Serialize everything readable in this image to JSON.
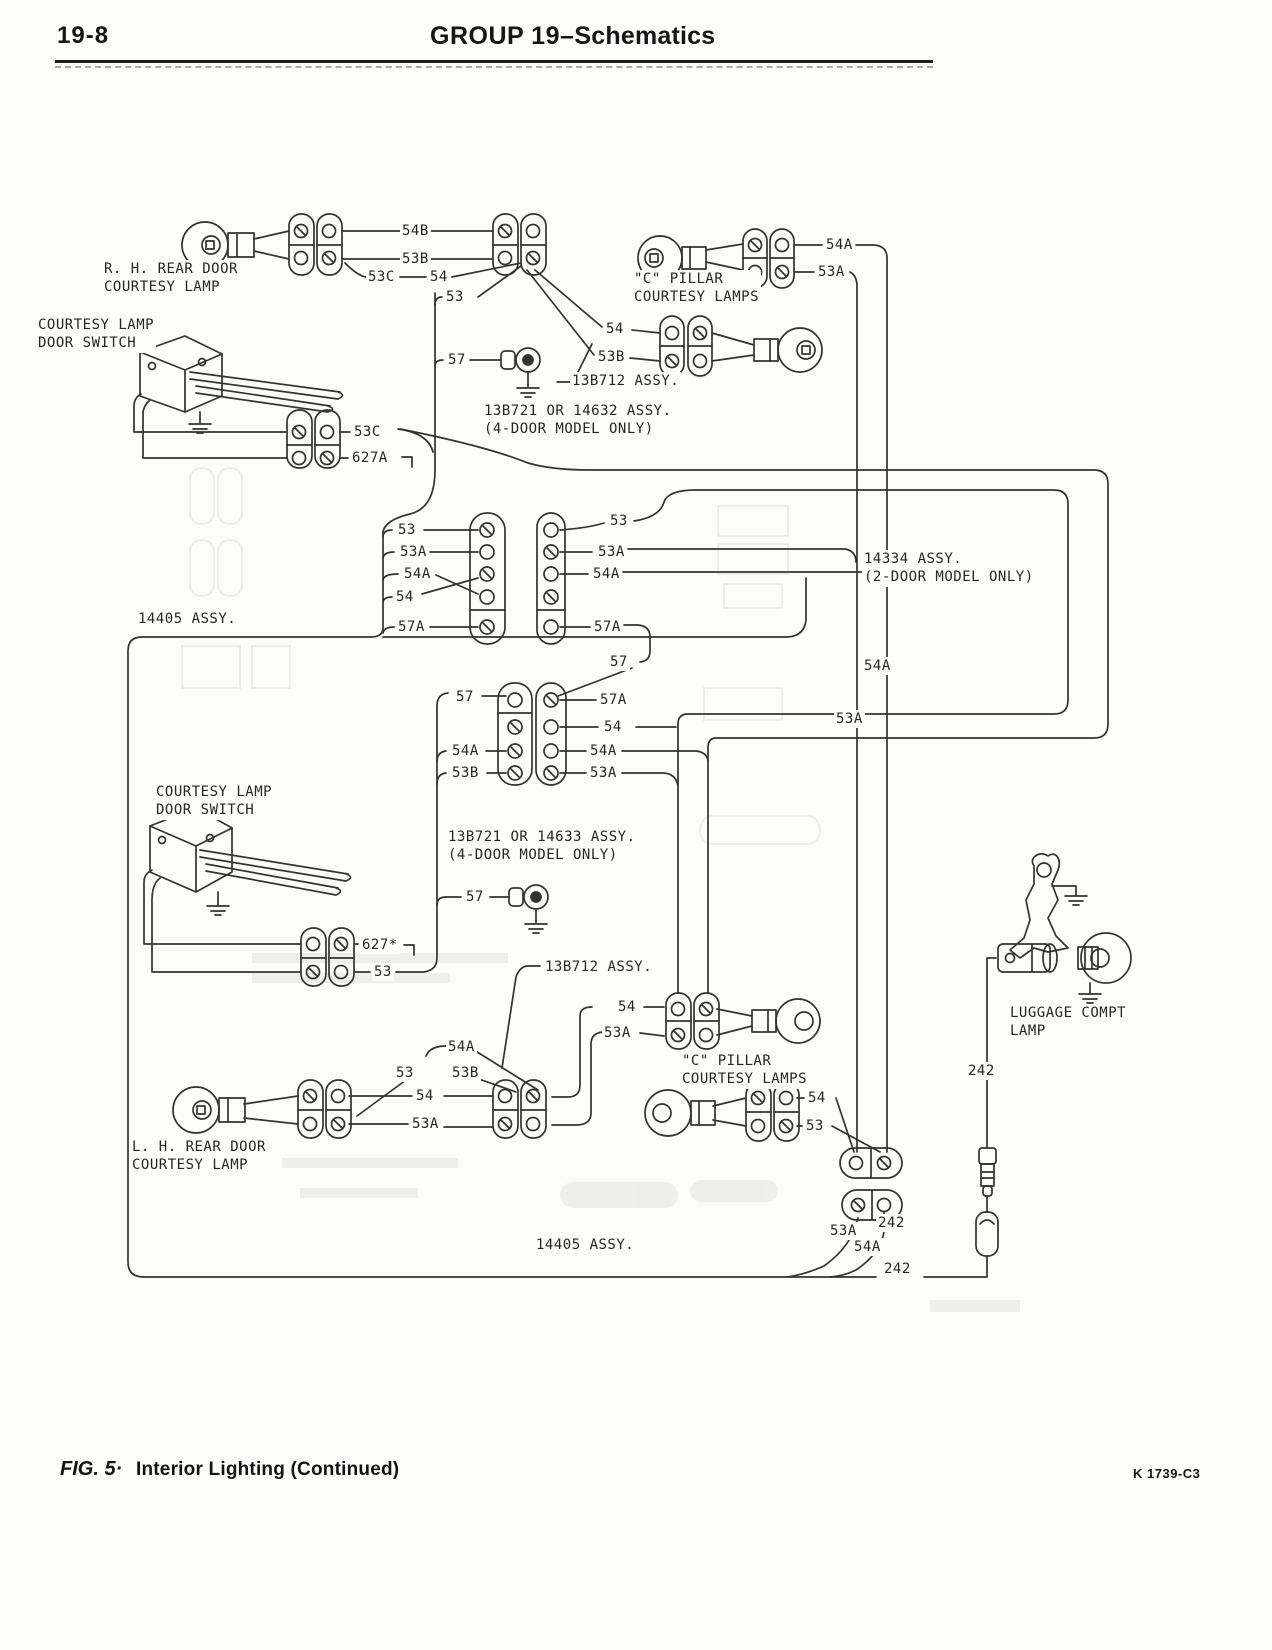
{
  "header": {
    "page_number": "19-8",
    "title_bold": "GROUP 19–",
    "title_light": "Schematics"
  },
  "footer": {
    "fig_label": "FIG. 5·",
    "fig_title": "Interior Lighting (Continued)",
    "doc_code": "K 1739-C3"
  },
  "colors": {
    "ink": "#333333",
    "paper": "#fcfcfb"
  },
  "labels": [
    {
      "name": "label-rh-rear-door-courtesy-lamp",
      "text": "R. H. REAR DOOR\nCOURTESY LAMP",
      "x": 102,
      "y": 260
    },
    {
      "name": "label-courtesy-lamp-door-switch-1",
      "text": "COURTESY LAMP\nDOOR SWITCH",
      "x": 36,
      "y": 316
    },
    {
      "name": "wire-54b",
      "text": "54B",
      "x": 400,
      "y": 222
    },
    {
      "name": "wire-53b",
      "text": "53B",
      "x": 400,
      "y": 250
    },
    {
      "name": "wire-53c",
      "text": "53C",
      "x": 366,
      "y": 268
    },
    {
      "name": "wire-54",
      "text": "54",
      "x": 428,
      "y": 268
    },
    {
      "name": "wire-53",
      "text": "53",
      "x": 444,
      "y": 288
    },
    {
      "name": "wire-57",
      "text": "57",
      "x": 446,
      "y": 351
    },
    {
      "name": "wire-54-cpillar1",
      "text": "54",
      "x": 604,
      "y": 320
    },
    {
      "name": "wire-53b-cpillar1",
      "text": "53B",
      "x": 596,
      "y": 348
    },
    {
      "name": "assy-13b712-1",
      "text": "13B712 ASSY.",
      "x": 570,
      "y": 372
    },
    {
      "name": "wire-54a-top",
      "text": "54A",
      "x": 824,
      "y": 236
    },
    {
      "name": "wire-53a-top",
      "text": "53A",
      "x": 816,
      "y": 263
    },
    {
      "name": "label-c-pillar-lamps-1",
      "text": "\"C\" PILLAR\nCOURTESY LAMPS",
      "x": 632,
      "y": 270
    },
    {
      "name": "assy-13b721-14632",
      "text": "13B721 OR 14632 ASSY.\n(4-DOOR MODEL ONLY)",
      "x": 482,
      "y": 402
    },
    {
      "name": "wire-53c-2",
      "text": "53C",
      "x": 352,
      "y": 423
    },
    {
      "name": "wire-627a",
      "text": "627A",
      "x": 350,
      "y": 449
    },
    {
      "name": "wire-53-g1l",
      "text": "53",
      "x": 396,
      "y": 521
    },
    {
      "name": "wire-53a-g1l",
      "text": "53A",
      "x": 398,
      "y": 543
    },
    {
      "name": "wire-54a-g1l",
      "text": "54A",
      "x": 402,
      "y": 565
    },
    {
      "name": "wire-54-g1l",
      "text": "54",
      "x": 394,
      "y": 588
    },
    {
      "name": "wire-57a-g1l",
      "text": "57A",
      "x": 396,
      "y": 618
    },
    {
      "name": "wire-53-g1r",
      "text": "53",
      "x": 608,
      "y": 512
    },
    {
      "name": "wire-53a-g1r",
      "text": "53A",
      "x": 596,
      "y": 543
    },
    {
      "name": "wire-54a-g1r",
      "text": "54A",
      "x": 591,
      "y": 565
    },
    {
      "name": "wire-57a-g1r",
      "text": "57A",
      "x": 592,
      "y": 618
    },
    {
      "name": "assy-14334",
      "text": "14334 ASSY.\n(2-DOOR MODEL ONLY)",
      "x": 862,
      "y": 550
    },
    {
      "name": "assy-14405-top",
      "text": "14405 ASSY.",
      "x": 136,
      "y": 610
    },
    {
      "name": "wire-54a-trunk",
      "text": "54A",
      "x": 862,
      "y": 657
    },
    {
      "name": "wire-53a-trunk",
      "text": "53A",
      "x": 834,
      "y": 710
    },
    {
      "name": "wire-57-g2r",
      "text": "57",
      "x": 608,
      "y": 653
    },
    {
      "name": "wire-57a-g2r",
      "text": "57A",
      "x": 598,
      "y": 691
    },
    {
      "name": "wire-57-g2l",
      "text": "57",
      "x": 454,
      "y": 688
    },
    {
      "name": "wire-54-g2r",
      "text": "54",
      "x": 602,
      "y": 718
    },
    {
      "name": "wire-54a-g2l",
      "text": "54A",
      "x": 450,
      "y": 742
    },
    {
      "name": "wire-54a-g2r",
      "text": "54A",
      "x": 588,
      "y": 742
    },
    {
      "name": "wire-53b-g2l",
      "text": "53B",
      "x": 450,
      "y": 764
    },
    {
      "name": "wire-53a-g2r",
      "text": "53A",
      "x": 588,
      "y": 764
    },
    {
      "name": "label-courtesy-lamp-door-switch-2",
      "text": "COURTESY LAMP\nDOOR SWITCH",
      "x": 154,
      "y": 783
    },
    {
      "name": "assy-13b721-14633",
      "text": "13B721 OR 14633 ASSY.\n(4-DOOR MODEL ONLY)",
      "x": 446,
      "y": 828
    },
    {
      "name": "wire-57-2",
      "text": "57",
      "x": 464,
      "y": 888
    },
    {
      "name": "wire-627",
      "text": "627*",
      "x": 360,
      "y": 936
    },
    {
      "name": "wire-53-2",
      "text": "53",
      "x": 372,
      "y": 963
    },
    {
      "name": "assy-13b712-2",
      "text": "13B712 ASSY.",
      "x": 543,
      "y": 958
    },
    {
      "name": "wire-54-3",
      "text": "54",
      "x": 616,
      "y": 998
    },
    {
      "name": "wire-53a-3",
      "text": "53A",
      "x": 602,
      "y": 1024
    },
    {
      "name": "label-c-pillar-lamps-2",
      "text": "\"C\" PILLAR\nCOURTESY LAMPS",
      "x": 680,
      "y": 1052
    },
    {
      "name": "wire-54-4",
      "text": "54",
      "x": 806,
      "y": 1089
    },
    {
      "name": "wire-53-3",
      "text": "53",
      "x": 804,
      "y": 1117
    },
    {
      "name": "label-luggage-compt-lamp",
      "text": "LUGGAGE COMPT\nLAMP",
      "x": 1008,
      "y": 1004
    },
    {
      "name": "wire-242-1",
      "text": "242",
      "x": 966,
      "y": 1062
    },
    {
      "name": "wire-54a-lh",
      "text": "54A",
      "x": 446,
      "y": 1038
    },
    {
      "name": "wire-53-lh",
      "text": "53",
      "x": 394,
      "y": 1064
    },
    {
      "name": "wire-53b-lh",
      "text": "53B",
      "x": 450,
      "y": 1064
    },
    {
      "name": "wire-54-lh",
      "text": "54",
      "x": 414,
      "y": 1087
    },
    {
      "name": "wire-53a-lh",
      "text": "53A",
      "x": 410,
      "y": 1115
    },
    {
      "name": "label-lh-rear-door-courtesy-lamp",
      "text": "L. H. REAR DOOR\nCOURTESY LAMP",
      "x": 130,
      "y": 1138
    },
    {
      "name": "wire-53a-4",
      "text": "53A",
      "x": 828,
      "y": 1222
    },
    {
      "name": "wire-242-2",
      "text": "242",
      "x": 876,
      "y": 1214
    },
    {
      "name": "wire-54a-4",
      "text": "54A",
      "x": 852,
      "y": 1238
    },
    {
      "name": "wire-242-3",
      "text": "242",
      "x": 882,
      "y": 1260
    },
    {
      "name": "assy-14405-bottom",
      "text": "14405 ASSY.",
      "x": 534,
      "y": 1236
    }
  ]
}
